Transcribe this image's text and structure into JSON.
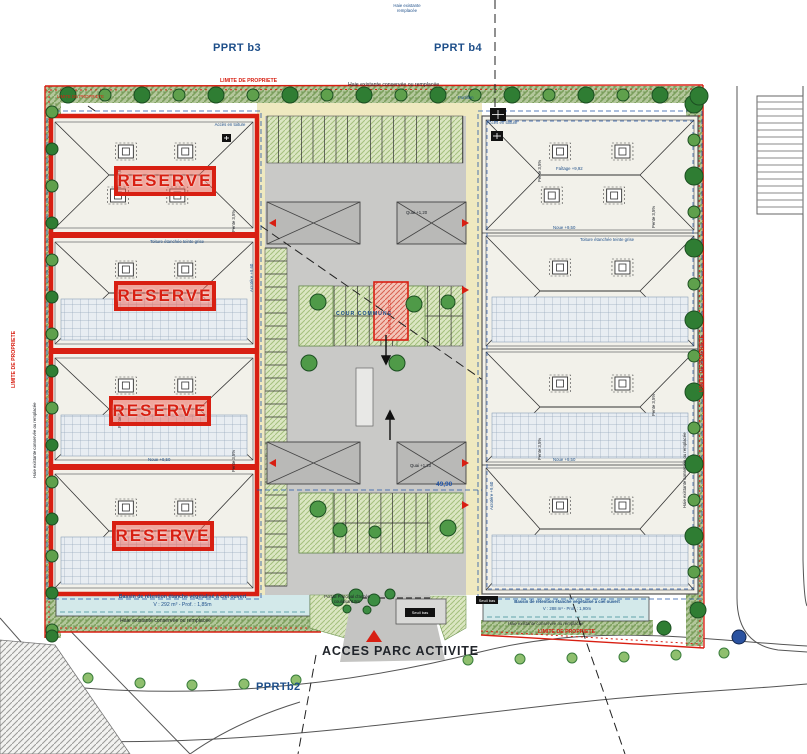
{
  "zones": {
    "pprt_b3": "PPRT b3",
    "pprt_b4": "PPRT b4",
    "pprt_b2": "PPRTb2"
  },
  "boundary": {
    "limite": "LIMITE DE PROPRIETE",
    "haie": "Haie existante conservée ou remplacée",
    "haie_top": "Haie existante remplacée"
  },
  "roof": {
    "reserve": "RESERVE",
    "pente": "Pente 3,5%",
    "faitage": "Faîtage +9,92",
    "noue": "Noue +9,50",
    "toiture": "Toiture étanchée teinte grise",
    "acces_toiture": "Accès en toiture",
    "acrotere": "Acrotère +9,60",
    "quai": "Quai +1,20"
  },
  "court": {
    "cour_commune": "COUR COMMUNE",
    "local": "PARKING VELOS",
    "portillon": "Portillon",
    "dim": "49,90",
    "seuil": "Seuil bas"
  },
  "basin_left": {
    "l1": "Bassin de rétention étanche végétalisé à ciel ouvert",
    "l2": "V : 292 m³ - Prof. : 1,85m"
  },
  "basin_right": {
    "l1": "Bassin de rétention étanche végétalisé à ciel ouvert",
    "l2": "V : 288 m³ - Prof. : 1,90m"
  },
  "access": {
    "portail": "Portail Principal d'accès coulissant 9m",
    "acces": "ACCES  PARC ACTIVITE"
  },
  "colors": {
    "red": "#d81f12",
    "blue": "#1d4e89",
    "dim_blue": "#2456a8",
    "court_gray": "#c9c9c7",
    "cream": "#efe9c0",
    "hedge": "#b3c79b",
    "basin": "#d3e9ea",
    "panel": "#e8edf2",
    "tree_dark": "#2f7d33",
    "tree_light": "#5fa04c"
  }
}
